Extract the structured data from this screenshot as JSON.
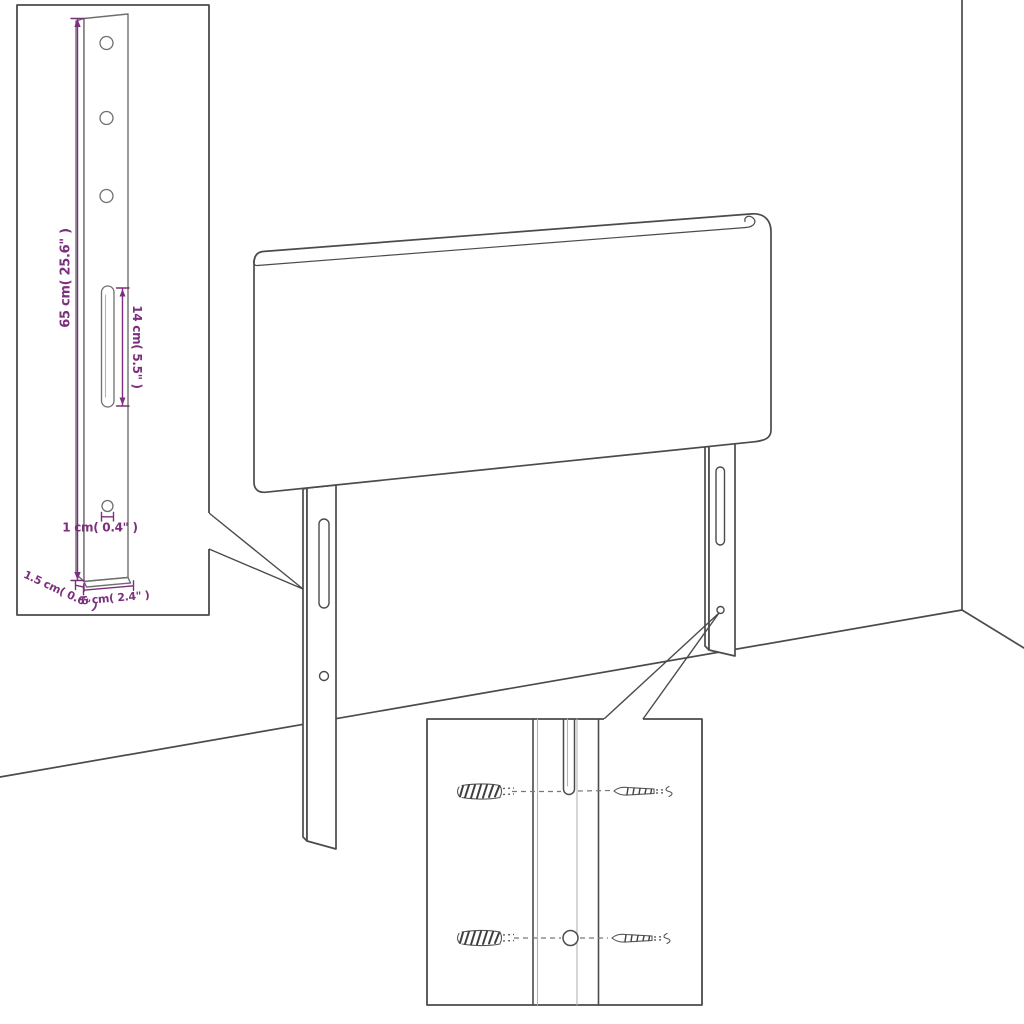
{
  "colors": {
    "background": "#ffffff",
    "line": "#4b4b4b",
    "line_light": "#b4b4b4",
    "dimension": "#7c2f7c"
  },
  "annotations": {
    "height_label": "65 cm( 25.6\" )",
    "slot_length_label": "14 cm( 5.5\" )",
    "hole_diameter_label": "1 cm( 0.4\" )",
    "thickness_label": "1.5 cm( 0.6\" )",
    "width_label": "6 cm( 2.4\" )"
  }
}
